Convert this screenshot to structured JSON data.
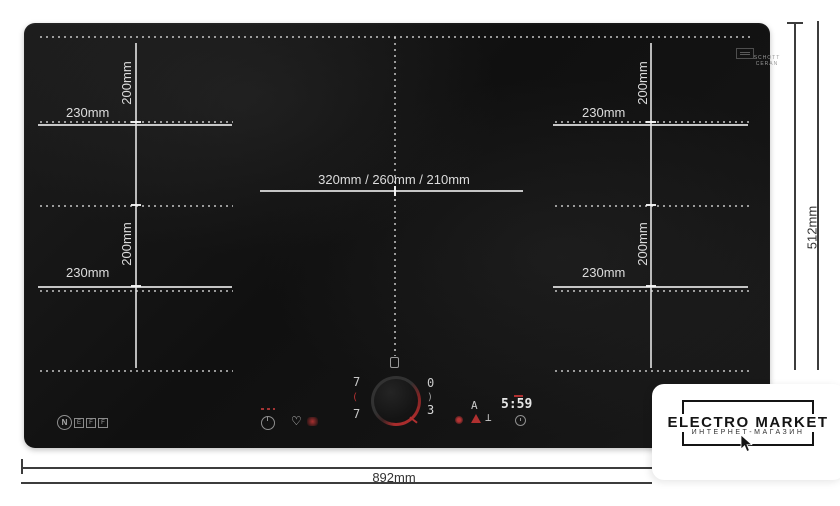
{
  "product": {
    "brand_letters": [
      "N",
      "E",
      "F",
      "F"
    ],
    "glass_brand_line1": "SCHOTT",
    "glass_brand_line2": "CERAN"
  },
  "dims": {
    "overall_width": "892mm",
    "overall_height": "512mm"
  },
  "zones": {
    "top_left": {
      "w": "230mm",
      "h": "200mm"
    },
    "bottom_left": {
      "w": "230mm",
      "h": "200mm"
    },
    "top_right": {
      "w": "230mm",
      "h": "200mm"
    },
    "bottom_right": {
      "w": "230mm",
      "h": "200mm"
    },
    "center": {
      "label": "320mm / 260mm / 210mm"
    }
  },
  "controls": {
    "zone_left_top_level": "7",
    "zone_left_bottom_level": "7",
    "bracket_left": "(",
    "bracket_right": ")",
    "zone_right_top_level": "0",
    "zone_right_bottom_level": "3",
    "auto_indicator": "A",
    "timer": "5:59"
  },
  "vendor": {
    "name": "ELECTRO MARKET",
    "subtitle": "ИНТЕРНЕТ-МАГАЗИН"
  },
  "colors": {
    "accent_red": "#b03030",
    "glass_line": "#e4e4e4",
    "dim_text": "#333333"
  }
}
